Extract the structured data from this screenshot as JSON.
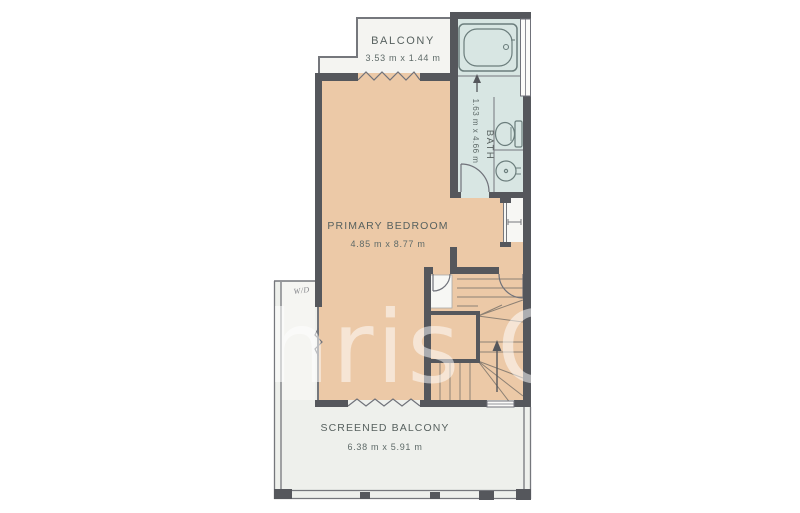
{
  "image_type": "residential floor plan (upper level)",
  "rooms": {
    "balcony": {
      "name": "BALCONY",
      "dims": "3.53 m x 1.44 m"
    },
    "bath": {
      "name": "BATH",
      "dims": "1.63 m x 4.66 m"
    },
    "primary_bedroom": {
      "name": "PRIMARY BEDROOM",
      "dims": "4.85 m x 8.77 m"
    },
    "screened_balcony": {
      "name": "SCREENED BALCONY",
      "dims": "6.38 m x 5.91 m"
    },
    "utility": {
      "name": "W/D"
    }
  },
  "watermark": {
    "text": "hris O"
  },
  "colors": {
    "wall": "#55575c",
    "bedroom_fill": "#ecc9a7",
    "bath_fill": "#d8e6e3",
    "balcony_fill": "#f4f4f1",
    "screened_balcony_fill": "#eef0ec",
    "closet_fill": "#f7f7f4",
    "label_text": "#57615f",
    "stair_tread_line": "#8d8174",
    "watermark": "rgba(255,255,255,0.52)"
  }
}
